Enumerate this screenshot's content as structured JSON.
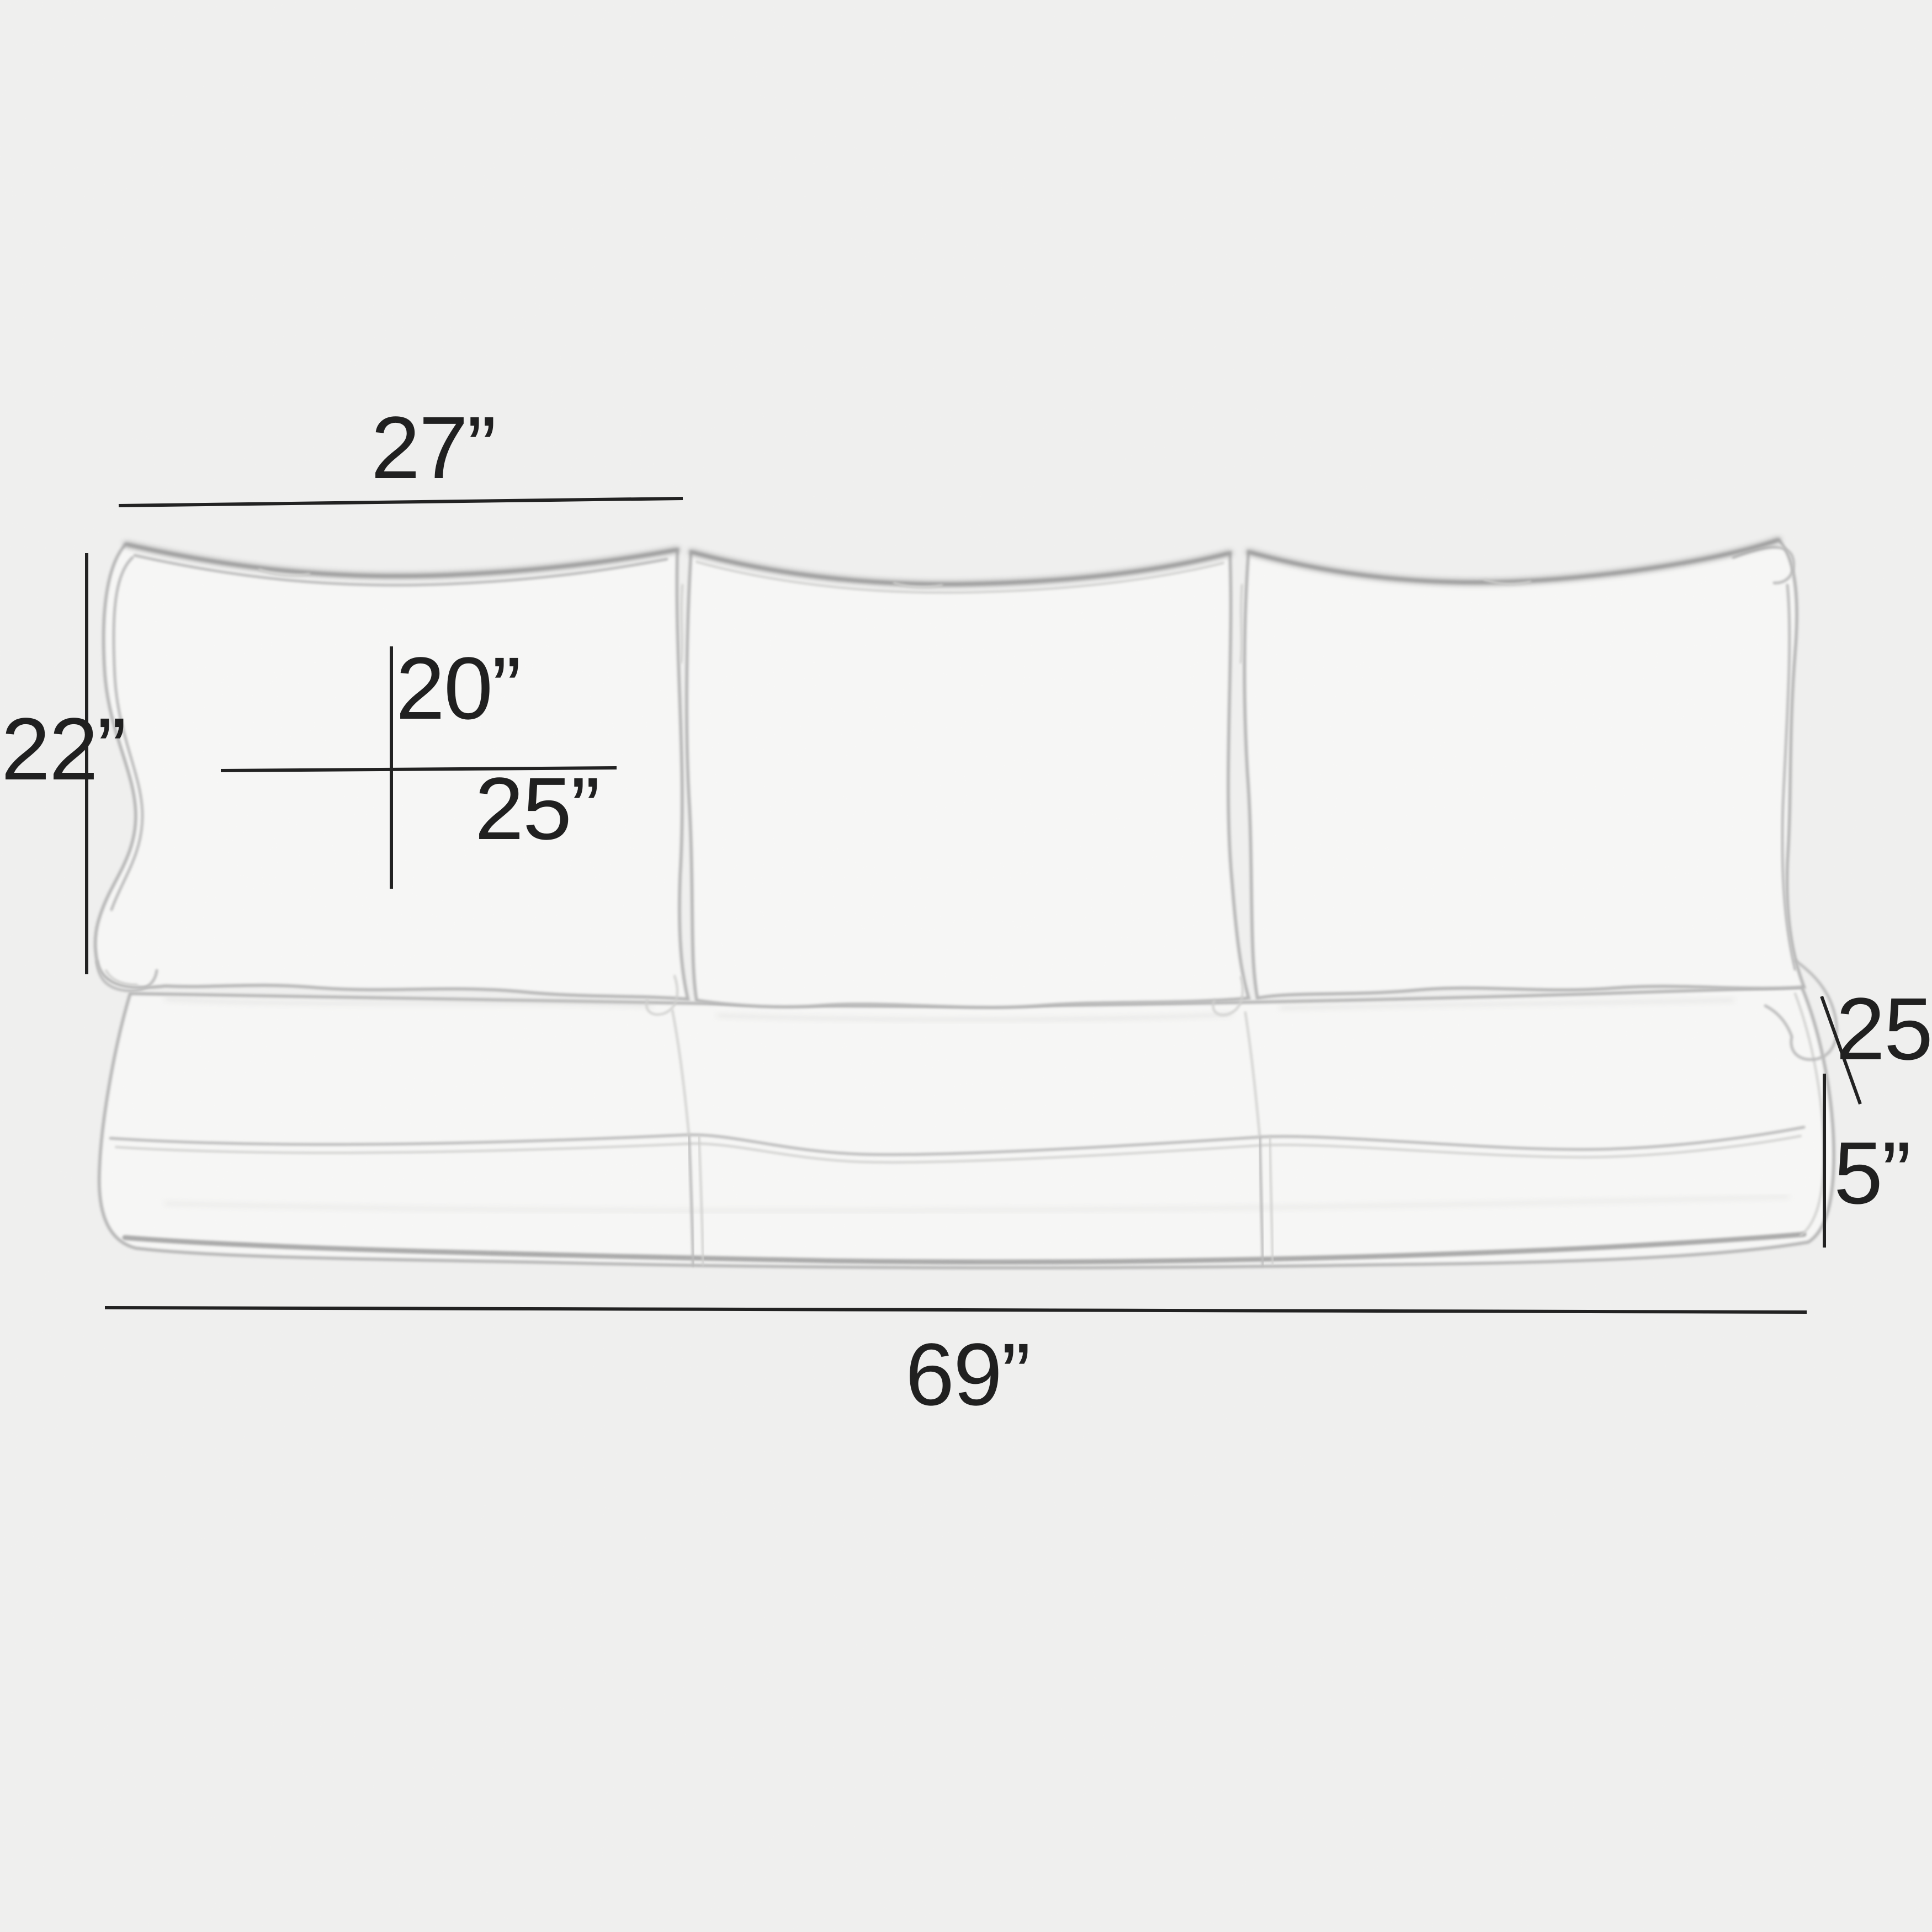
{
  "figure": {
    "kind": "product-dimension-diagram",
    "subject": "three-seat sofa cushion set (three back pillows over three seat cushions), pencil-sketch line art on light paper background"
  },
  "diagram": {
    "background_color": "#f3f3f2",
    "ink_color": "#1a1a1a",
    "sketch_color": "#b7b7b7",
    "labels": {
      "back_pillow_width": "27”",
      "back_pillow_height": "22”",
      "back_pillow_inner_height": "20”",
      "back_pillow_inner_width": "25”",
      "seat_depth": "25”",
      "seat_base_thickness": "5”",
      "overall_width": "69”"
    }
  }
}
